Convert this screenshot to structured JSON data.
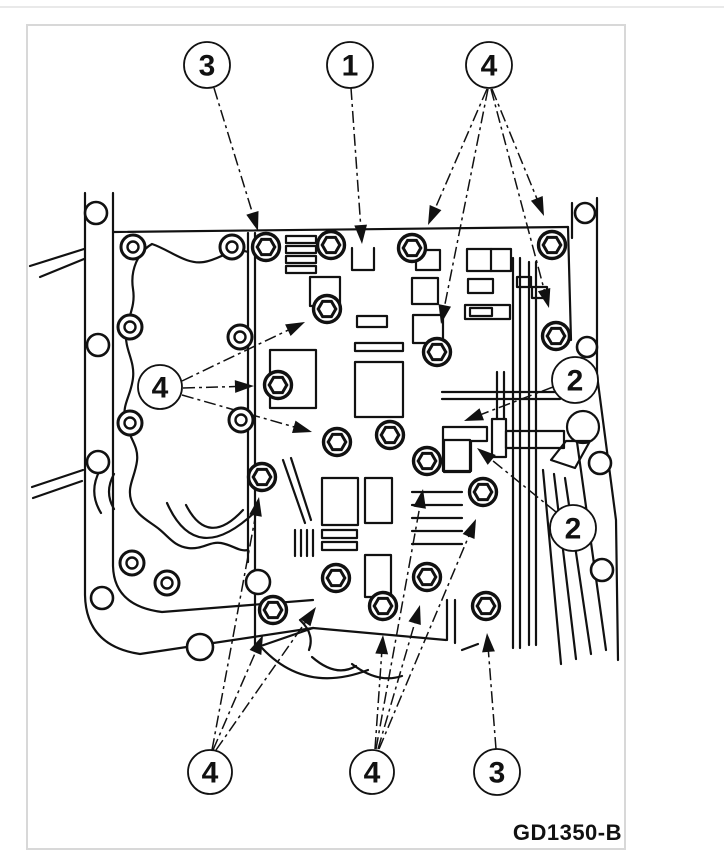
{
  "page": {
    "rule_color": "#e9e9e9",
    "frame_color": "#d8d8d8",
    "ink_color": "#111111"
  },
  "figure": {
    "code": "GD1350-B",
    "description": "valve-body-bolt-location-diagram",
    "callouts": [
      {
        "id": "callout-3-top",
        "label": "3",
        "cx": 207,
        "cy": 65,
        "r": 23
      },
      {
        "id": "callout-1-top",
        "label": "1",
        "cx": 350,
        "cy": 65,
        "r": 23
      },
      {
        "id": "callout-4-top-right",
        "label": "4",
        "cx": 489,
        "cy": 65,
        "r": 23
      },
      {
        "id": "callout-4-left",
        "label": "4",
        "cx": 160,
        "cy": 387,
        "r": 22
      },
      {
        "id": "callout-2-upper",
        "label": "2",
        "cx": 575,
        "cy": 380,
        "r": 23
      },
      {
        "id": "callout-2-lower",
        "label": "2",
        "cx": 573,
        "cy": 528,
        "r": 23
      },
      {
        "id": "callout-4-bottom-left",
        "label": "4",
        "cx": 210,
        "cy": 772,
        "r": 22
      },
      {
        "id": "callout-4-bottom-center",
        "label": "4",
        "cx": 372,
        "cy": 772,
        "r": 22
      },
      {
        "id": "callout-3-bottom",
        "label": "3",
        "cx": 497,
        "cy": 772,
        "r": 23
      }
    ],
    "bolts": [
      {
        "x": 266,
        "y": 247,
        "callout": "3"
      },
      {
        "x": 331,
        "y": 245,
        "callout": ""
      },
      {
        "x": 412,
        "y": 248,
        "callout": "4"
      },
      {
        "x": 552,
        "y": 245,
        "callout": "4"
      },
      {
        "x": 327,
        "y": 309,
        "callout": "4"
      },
      {
        "x": 556,
        "y": 336,
        "callout": "4"
      },
      {
        "x": 437,
        "y": 352,
        "callout": "4"
      },
      {
        "x": 278,
        "y": 385,
        "callout": "4"
      },
      {
        "x": 337,
        "y": 442,
        "callout": "4"
      },
      {
        "x": 390,
        "y": 435,
        "callout": ""
      },
      {
        "x": 427,
        "y": 461,
        "callout": "4"
      },
      {
        "x": 262,
        "y": 477,
        "callout": "4"
      },
      {
        "x": 483,
        "y": 492,
        "callout": "4"
      },
      {
        "x": 273,
        "y": 610,
        "callout": "4"
      },
      {
        "x": 336,
        "y": 578,
        "callout": "4"
      },
      {
        "x": 383,
        "y": 606,
        "callout": "4"
      },
      {
        "x": 427,
        "y": 577,
        "callout": "4"
      },
      {
        "x": 486,
        "y": 606,
        "callout": "3"
      }
    ],
    "case_holes": [
      {
        "x": 133,
        "y": 247
      },
      {
        "x": 232,
        "y": 247
      },
      {
        "x": 130,
        "y": 327
      },
      {
        "x": 240,
        "y": 337
      },
      {
        "x": 130,
        "y": 423
      },
      {
        "x": 241,
        "y": 420
      },
      {
        "x": 132,
        "y": 563
      },
      {
        "x": 167,
        "y": 583
      }
    ],
    "flange_holes": [
      {
        "x": 96,
        "y": 213,
        "r": 11
      },
      {
        "x": 98,
        "y": 345,
        "r": 11
      },
      {
        "x": 98,
        "y": 462,
        "r": 11
      },
      {
        "x": 102,
        "y": 598,
        "r": 11
      },
      {
        "x": 200,
        "y": 647,
        "r": 13
      },
      {
        "x": 258,
        "y": 582,
        "r": 12
      },
      {
        "x": 585,
        "y": 213,
        "r": 10
      },
      {
        "x": 587,
        "y": 347,
        "r": 10
      },
      {
        "x": 600,
        "y": 463,
        "r": 11
      },
      {
        "x": 602,
        "y": 570,
        "r": 11
      }
    ],
    "arrows": [
      {
        "callout": "3",
        "x1": 214,
        "y1": 88,
        "x2": 258,
        "y2": 231
      },
      {
        "callout": "1",
        "x1": 351,
        "y1": 88,
        "x2": 362,
        "y2": 244
      },
      {
        "callout": "4",
        "x1": 487,
        "y1": 89,
        "x2": 428,
        "y2": 225
      },
      {
        "callout": "4",
        "x1": 492,
        "y1": 89,
        "x2": 544,
        "y2": 216
      },
      {
        "callout": "4",
        "x1": 488,
        "y1": 89,
        "x2": 441,
        "y2": 324
      },
      {
        "callout": "4",
        "x1": 491,
        "y1": 89,
        "x2": 549,
        "y2": 308
      },
      {
        "callout": "4",
        "x1": 182,
        "y1": 381,
        "x2": 305,
        "y2": 322
      },
      {
        "callout": "4",
        "x1": 183,
        "y1": 388,
        "x2": 254,
        "y2": 386
      },
      {
        "callout": "4",
        "x1": 182,
        "y1": 395,
        "x2": 312,
        "y2": 432
      },
      {
        "callout": "2",
        "x1": 553,
        "y1": 387,
        "x2": 464,
        "y2": 421
      },
      {
        "callout": "2",
        "x1": 556,
        "y1": 512,
        "x2": 477,
        "y2": 448
      },
      {
        "callout": "4",
        "x1": 212,
        "y1": 750,
        "x2": 259,
        "y2": 497
      },
      {
        "callout": "4",
        "x1": 213,
        "y1": 750,
        "x2": 263,
        "y2": 635
      },
      {
        "callout": "4",
        "x1": 216,
        "y1": 750,
        "x2": 316,
        "y2": 607
      },
      {
        "callout": "4",
        "x1": 376,
        "y1": 749,
        "x2": 423,
        "y2": 489
      },
      {
        "callout": "4",
        "x1": 379,
        "y1": 749,
        "x2": 476,
        "y2": 519
      },
      {
        "callout": "4",
        "x1": 378,
        "y1": 749,
        "x2": 420,
        "y2": 605
      },
      {
        "callout": "4",
        "x1": 375,
        "y1": 749,
        "x2": 383,
        "y2": 635
      },
      {
        "callout": "3",
        "x1": 496,
        "y1": 749,
        "x2": 487,
        "y2": 633
      }
    ]
  }
}
